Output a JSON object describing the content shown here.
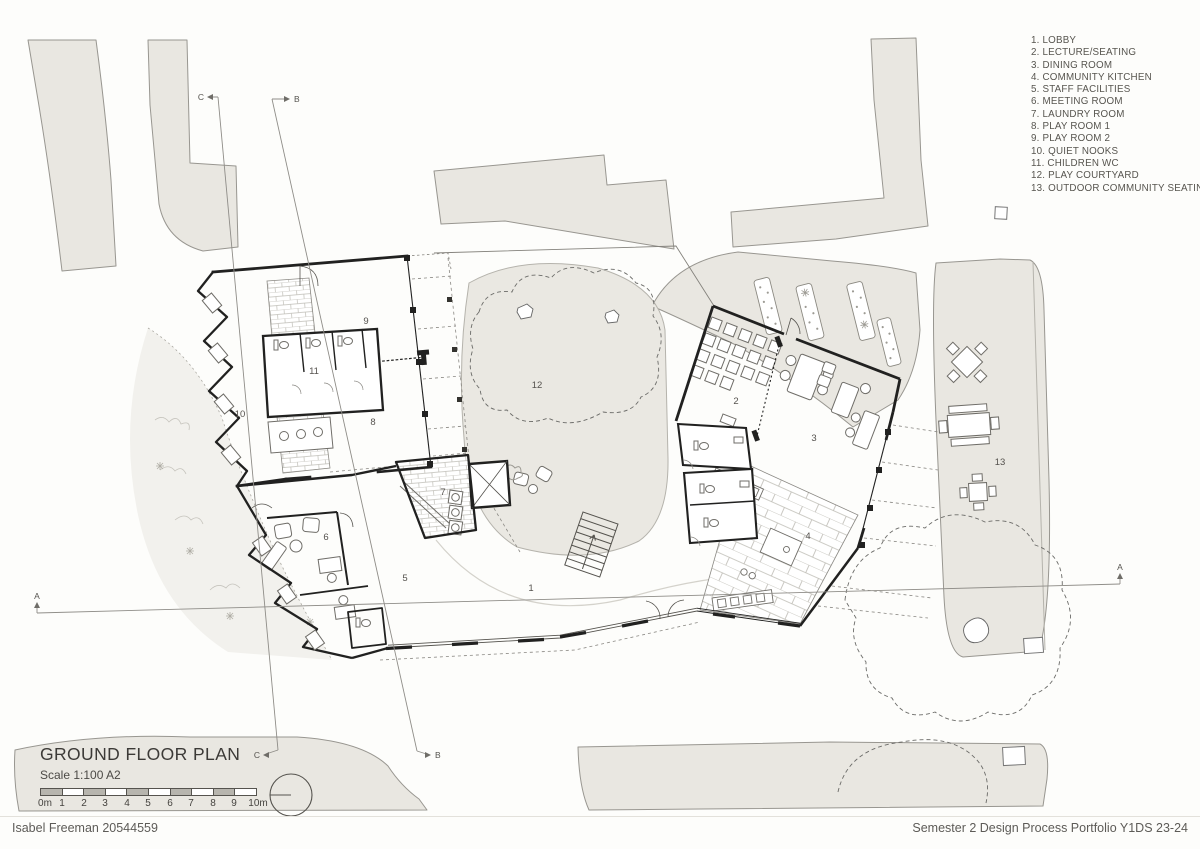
{
  "page": {
    "footer_left": "Isabel Freeman 20544559",
    "footer_right": "Semester 2 Design Process Portfolio Y1DS 23-24"
  },
  "title_block": {
    "title": "GROUND FLOOR PLAN",
    "scale": "Scale 1:100 A2",
    "scale_bar_labels": [
      "0m",
      "1",
      "2",
      "3",
      "4",
      "5",
      "6",
      "7",
      "8",
      "9",
      "10m"
    ]
  },
  "legend": {
    "items": [
      "1. LOBBY",
      "2. LECTURE/SEATING",
      "3. DINING ROOM",
      "4. COMMUNITY KITCHEN",
      "5. STAFF FACILITIES",
      "6. MEETING ROOM",
      "7. LAUNDRY ROOM",
      "8. PLAY ROOM 1",
      "9. PLAY ROOM 2",
      "10. QUIET NOOKS",
      "11. CHILDREN WC",
      "12. PLAY COURTYARD",
      "13. OUTDOOR COMMUNITY SEATING"
    ]
  },
  "rooms": [
    "1",
    "2",
    "3",
    "4",
    "5",
    "6",
    "7",
    "8",
    "9",
    "10",
    "11",
    "12",
    "13"
  ],
  "sections": {
    "a": "A",
    "b": "B",
    "c": "C"
  },
  "colors": {
    "context_fill": "#e9e7e1",
    "wall": "#212120",
    "thin_line": "#8f8d88",
    "text": "#57554f"
  }
}
